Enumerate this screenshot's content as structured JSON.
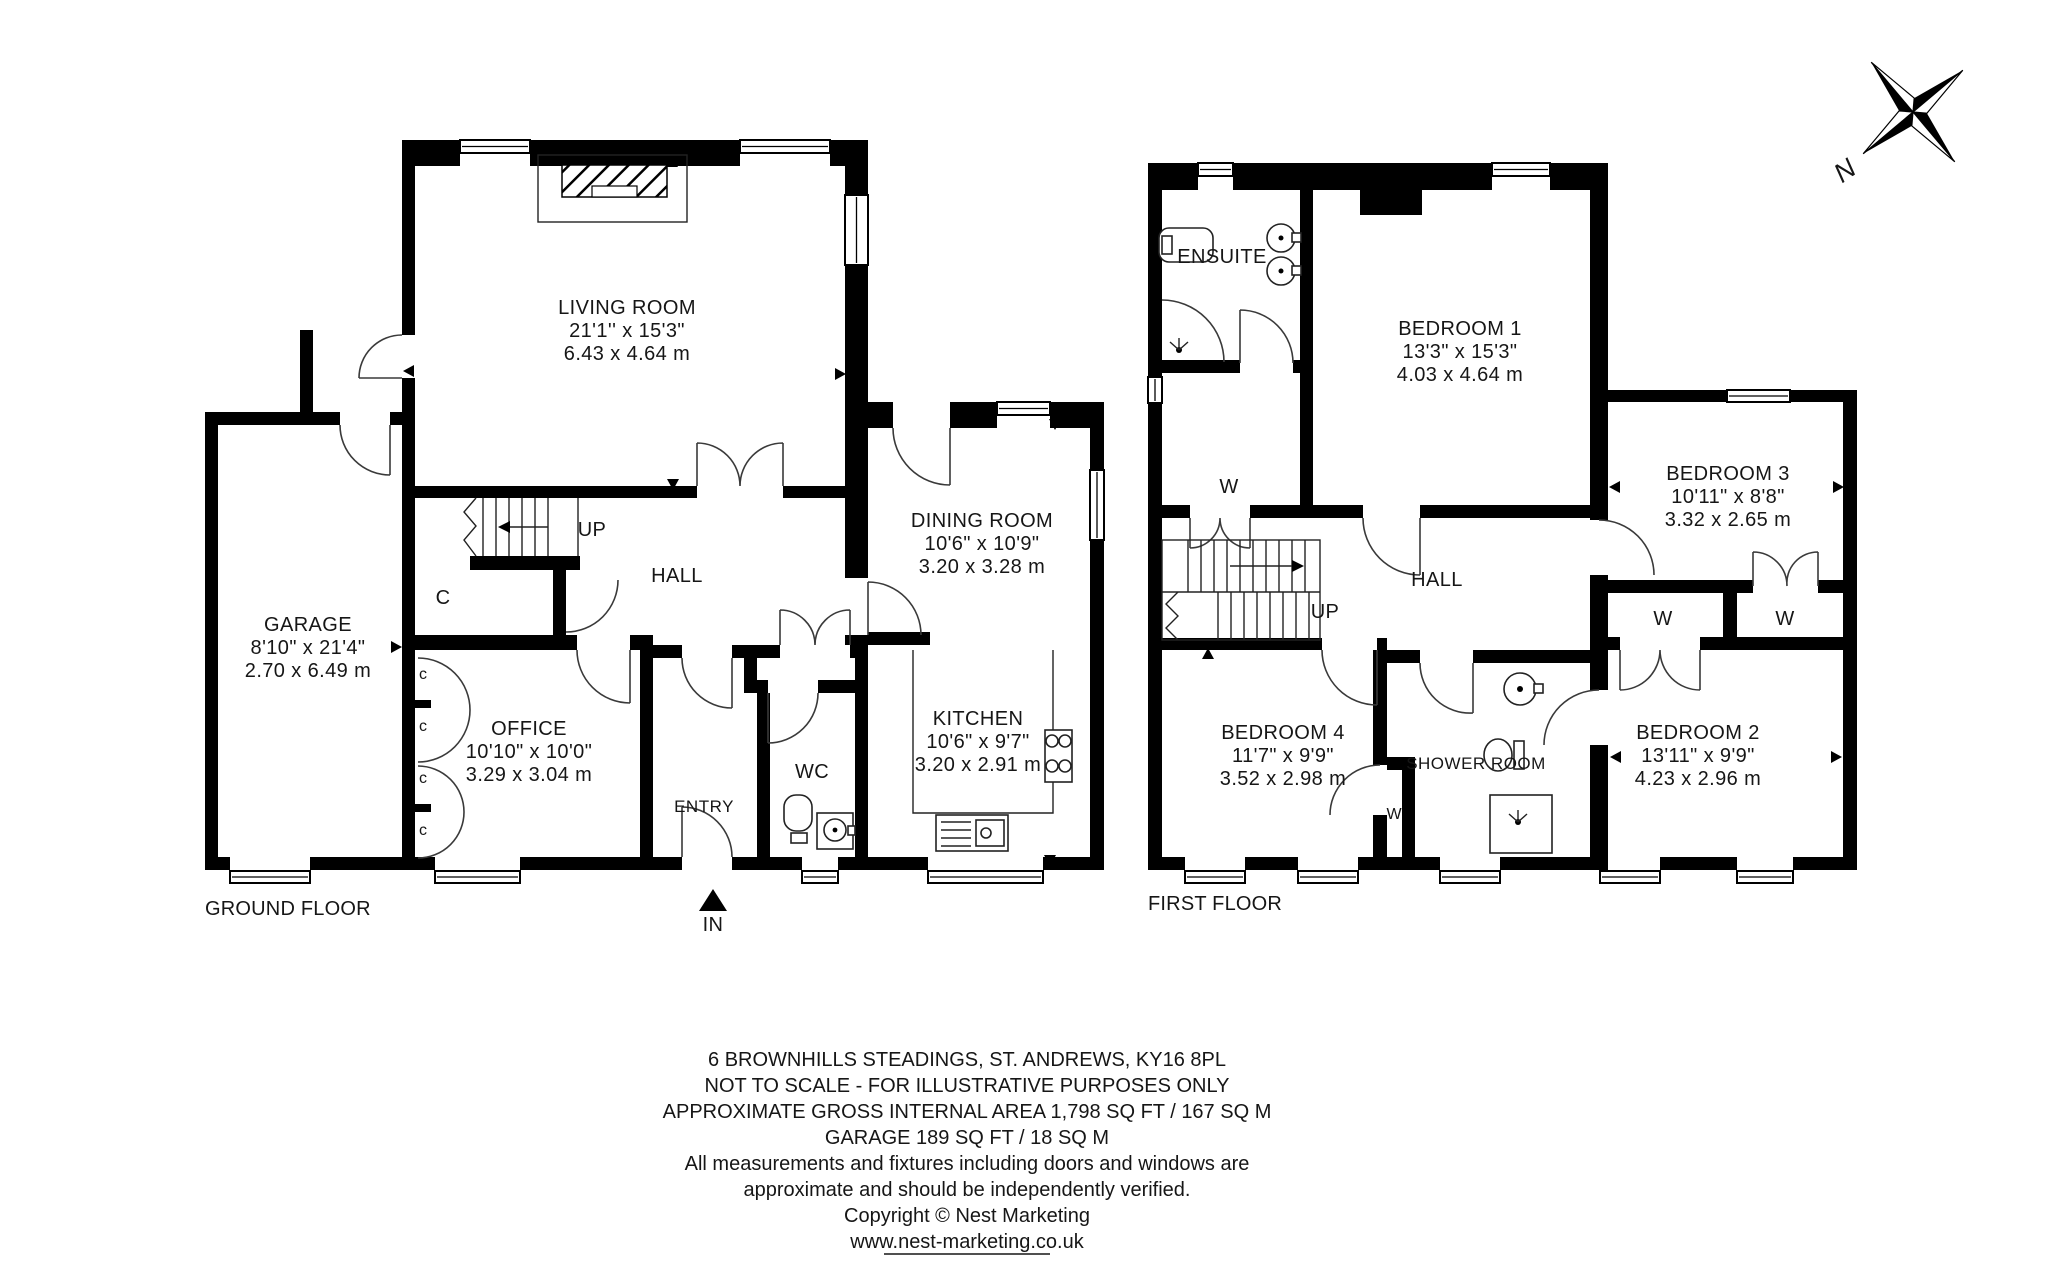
{
  "compass": {
    "north_label": "N"
  },
  "ground_floor": {
    "caption": "GROUND FLOOR",
    "rooms": {
      "living_room": {
        "name": "LIVING ROOM",
        "imperial": "21'1'' x 15'3\"",
        "metric": "6.43 x 4.64 m"
      },
      "garage": {
        "name": "GARAGE",
        "imperial": "8'10\" x 21'4\"",
        "metric": "2.70 x 6.49 m"
      },
      "office": {
        "name": "OFFICE",
        "imperial": "10'10\" x 10'0\"",
        "metric": "3.29 x 3.04 m"
      },
      "dining_room": {
        "name": "DINING ROOM",
        "imperial": "10'6\" x 10'9\"",
        "metric": "3.20 x 3.28 m"
      },
      "kitchen": {
        "name": "KITCHEN",
        "imperial": "10'6\" x 9'7\"",
        "metric": "3.20 x 2.91 m"
      },
      "hall": {
        "name": "HALL"
      },
      "wc": {
        "name": "WC"
      },
      "entry": {
        "name": "ENTRY"
      }
    },
    "annotations": {
      "up": "UP",
      "closet": "C",
      "closet_small": "c",
      "entrance": "IN"
    }
  },
  "first_floor": {
    "caption": "FIRST FLOOR",
    "rooms": {
      "bedroom_1": {
        "name": "BEDROOM 1",
        "imperial": "13'3\" x 15'3\"",
        "metric": "4.03 x 4.64 m"
      },
      "bedroom_2": {
        "name": "BEDROOM 2",
        "imperial": "13'11\" x 9'9\"",
        "metric": "4.23 x 2.96 m"
      },
      "bedroom_3": {
        "name": "BEDROOM 3",
        "imperial": "10'11\" x 8'8\"",
        "metric": "3.32 x 2.65 m"
      },
      "bedroom_4": {
        "name": "BEDROOM 4",
        "imperial": "11'7\" x 9'9\"",
        "metric": "3.52 x 2.98 m"
      },
      "ensuite": {
        "name": "ENSUITE"
      },
      "shower_room": {
        "name": "SHOWER ROOM"
      },
      "hall": {
        "name": "HALL"
      }
    },
    "annotations": {
      "up": "UP",
      "wardrobe": "W"
    }
  },
  "footer": {
    "lines": [
      "6 BROWNHILLS STEADINGS, ST. ANDREWS, KY16 8PL",
      "NOT TO SCALE - FOR ILLUSTRATIVE PURPOSES ONLY",
      "APPROXIMATE GROSS INTERNAL AREA 1,798 SQ FT / 167 SQ M",
      "GARAGE 189 SQ FT / 18 SQ M",
      "All measurements and fixtures including doors and windows are",
      "approximate and should be independently verified.",
      "Copyright © Nest Marketing",
      "www.nest-marketing.co.uk"
    ]
  }
}
